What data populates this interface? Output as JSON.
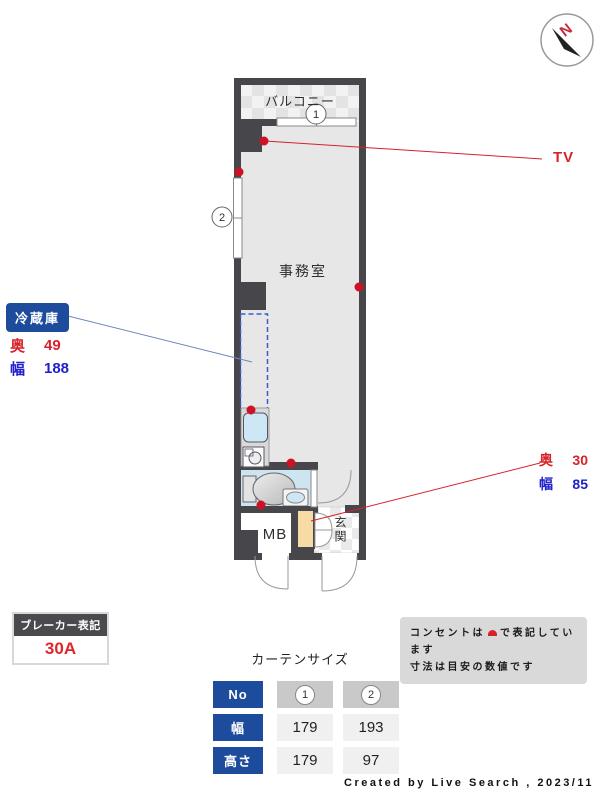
{
  "compass": {
    "north_label": "N"
  },
  "plan": {
    "balcony_label": "バルコニー",
    "room_label": "事務室",
    "mb_label": "MB",
    "entrance_label": "玄関",
    "window_nos": [
      "1",
      "2"
    ],
    "tv_label": "TV"
  },
  "fridge_callout": {
    "title": "冷蔵庫",
    "rows": [
      {
        "label": "奥",
        "value": "49"
      },
      {
        "label": "幅",
        "value": "188"
      }
    ]
  },
  "shoebox_callout": {
    "rows": [
      {
        "label": "奥",
        "value": "30"
      },
      {
        "label": "幅",
        "value": "85"
      }
    ]
  },
  "breaker": {
    "title": "ブレーカー表記",
    "value": "30A"
  },
  "note": {
    "line1_prefix": "コンセントは",
    "line1_suffix": "で表記しています",
    "line2": "寸法は目安の数値です"
  },
  "curtain": {
    "title": "カーテンサイズ",
    "row_headers": [
      "No",
      "幅",
      "高さ"
    ],
    "columns": [
      {
        "no": "1",
        "width": "179",
        "height": "179"
      },
      {
        "no": "2",
        "width": "193",
        "height": "97"
      }
    ]
  },
  "footer": {
    "credit": "Created by Live Search , 2023/11"
  },
  "colors": {
    "wall": "#47474b",
    "floor": "#e7e7e7",
    "bath": "#cfe4f1",
    "accent_navy": "#1d4c9c",
    "accent_red": "#d7222b",
    "accent_blue": "#2020cc",
    "shoebox_tan": "#f6dca4"
  }
}
